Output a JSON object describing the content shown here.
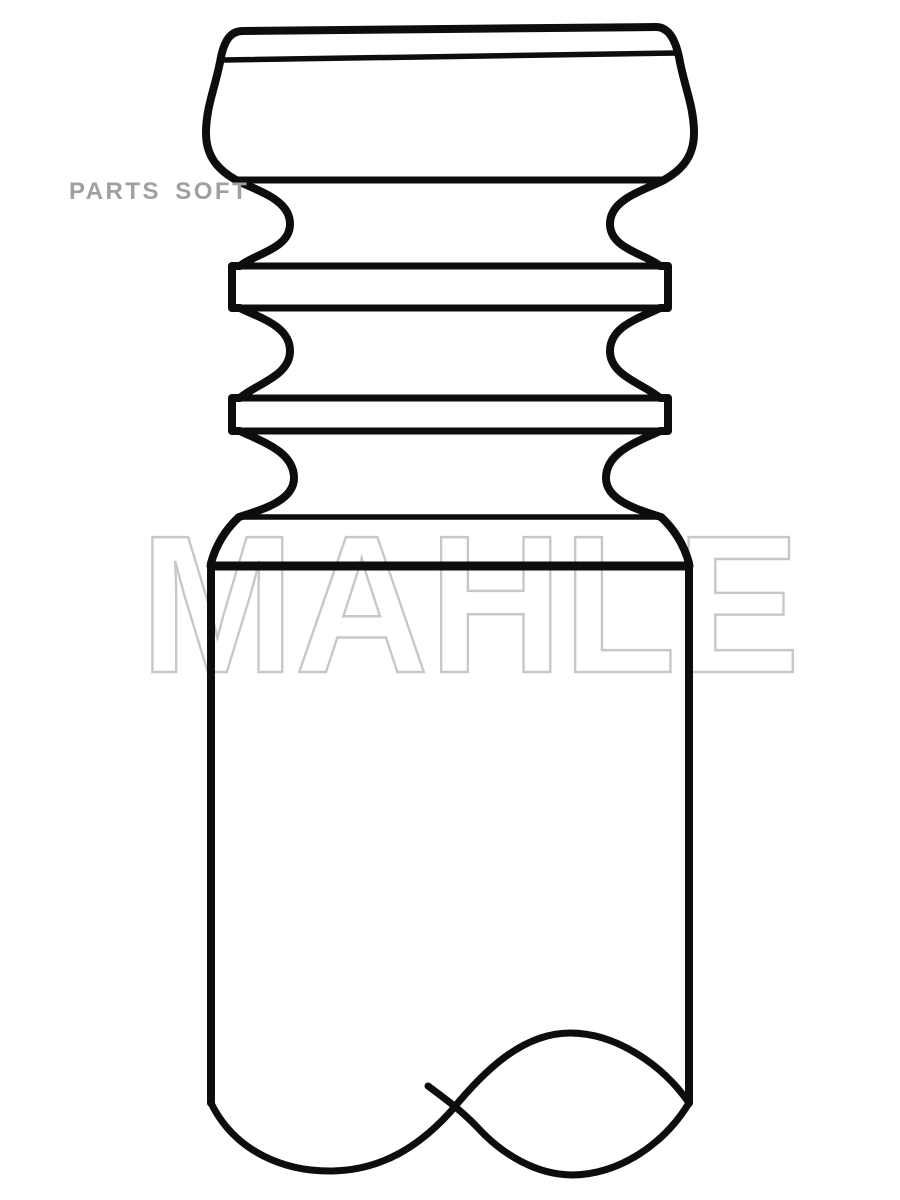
{
  "page": {
    "background_color": "#ffffff"
  },
  "drawing": {
    "kind": "engine-valve-technical-line-drawing",
    "outline_color": "#0d0d0d"
  },
  "watermarks": {
    "parts_soft": {
      "text": "PARTS SOFT",
      "color": "#a0a0a0"
    },
    "brand": {
      "text": "MAHLE",
      "color": "#c7c7c7"
    }
  }
}
